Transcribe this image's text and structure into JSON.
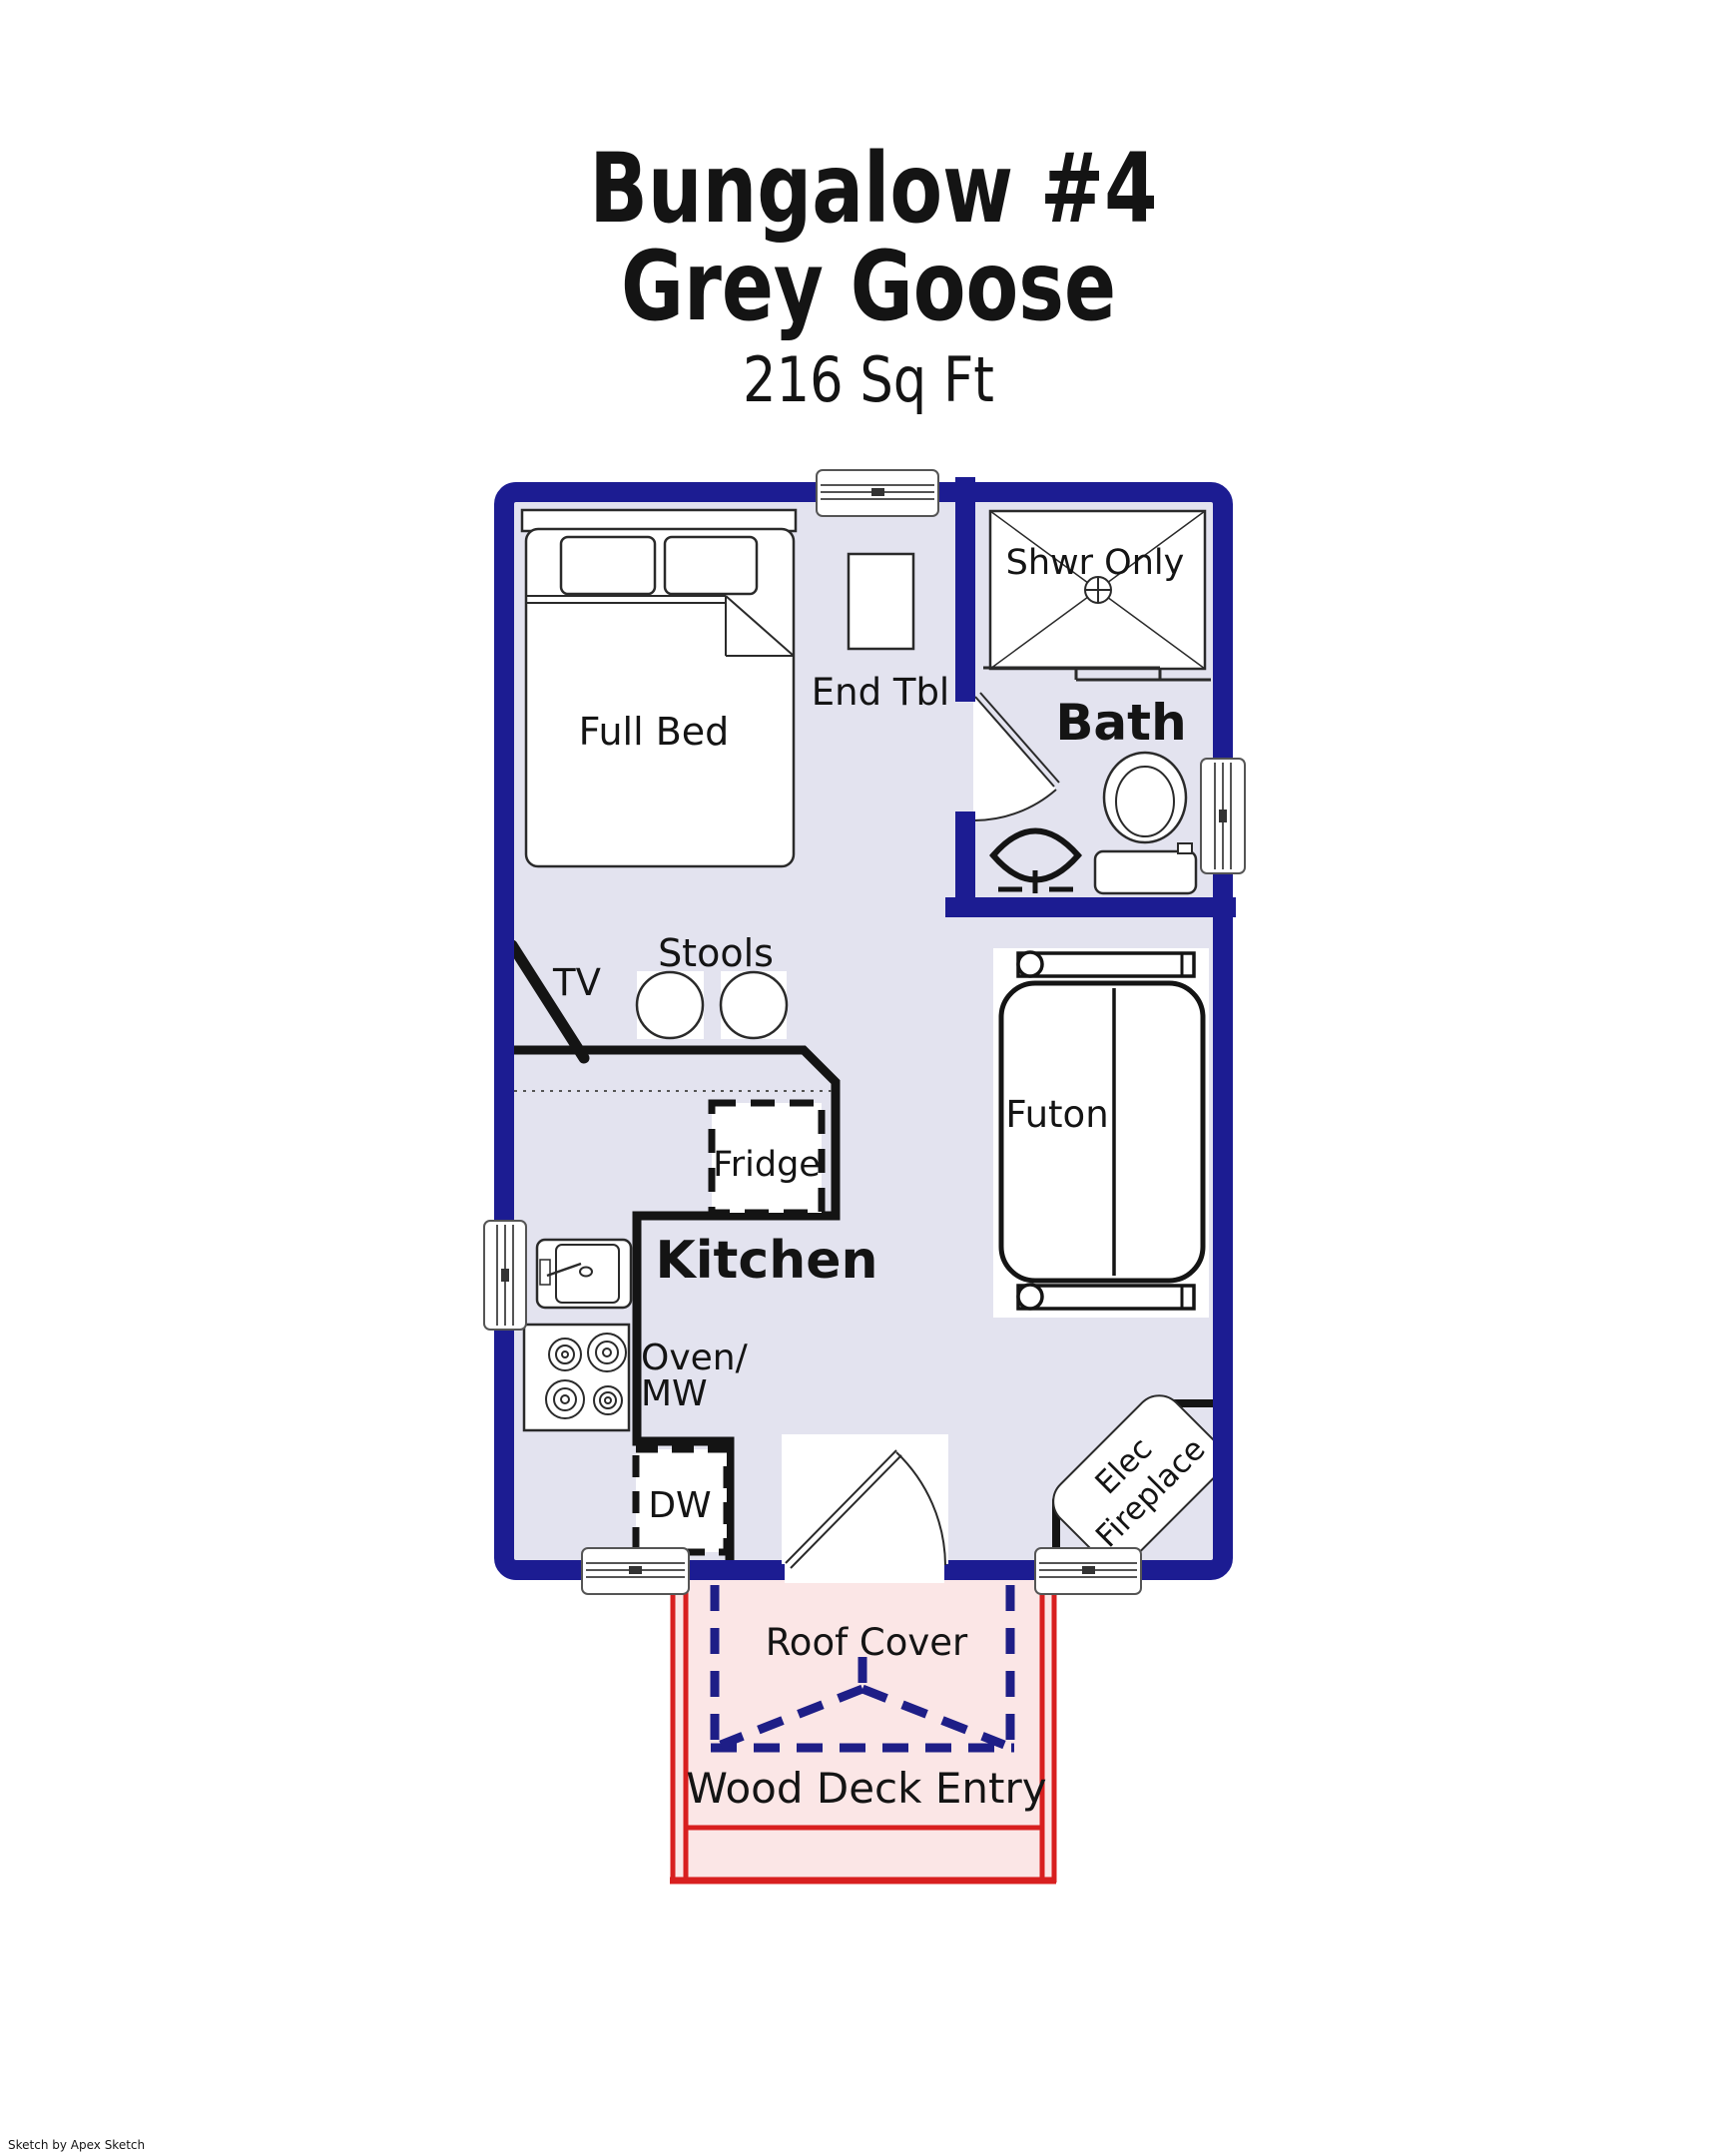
{
  "title": {
    "line1": "Bungalow #4",
    "line2": "Grey Goose",
    "area": "216 Sq Ft"
  },
  "colors": {
    "wall": "#1c1c92",
    "interior": "#e3e3ef",
    "deck_fill": "#fbe6e6",
    "deck_line": "#d81f1f",
    "roof_dash": "#1e1e87",
    "line_black": "#141414",
    "fixture_stroke": "#2a2a2a",
    "window_stroke": "#555555"
  },
  "floor_plan": {
    "rooms": {
      "bath_label": "Bath",
      "kitchen_label": "Kitchen"
    },
    "labels": {
      "full_bed": "Full Bed",
      "end_table": "End Tbl",
      "shower": "Shwr Only",
      "tv": "TV",
      "stools": "Stools",
      "fridge": "Fridge",
      "futon": "Futon",
      "oven_line1": "Oven/",
      "oven_line2": "MW",
      "dishwasher": "DW",
      "fireplace_line1": "Elec",
      "fireplace_line2": "Fireplace",
      "roof_cover": "Roof Cover",
      "wood_deck": "Wood Deck Entry"
    }
  },
  "credit": "Sketch by Apex Sketch"
}
